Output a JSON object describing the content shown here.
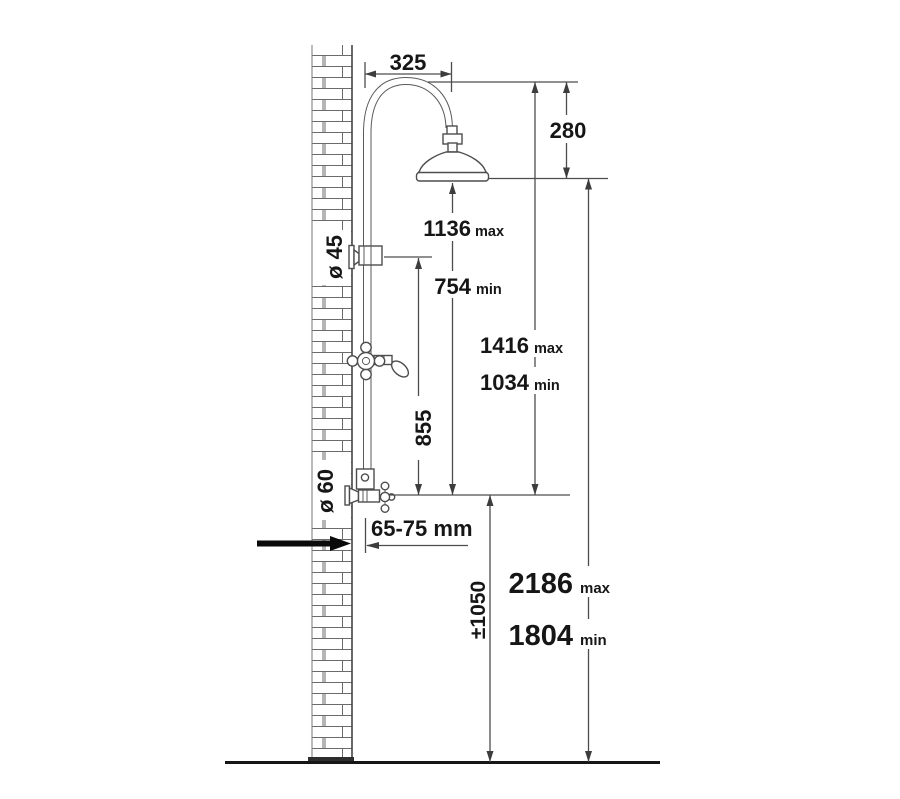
{
  "diagram": {
    "title": "shower-column-installation-dimensions",
    "colors": {
      "line": "#4d4d4d",
      "text": "#161616",
      "background": "#ffffff"
    },
    "dims": {
      "top_reach": {
        "value": "325"
      },
      "head_height": {
        "value": "280"
      },
      "head_max": {
        "value": "1136",
        "suffix": "max"
      },
      "head_min": {
        "value": "754",
        "suffix": "min"
      },
      "riser_max": {
        "value": "1416",
        "suffix": "max"
      },
      "riser_min": {
        "value": "1034",
        "suffix": "min"
      },
      "bracket_to_valve": {
        "value": "855"
      },
      "wall_offset": {
        "value": "65-75 mm"
      },
      "total_max": {
        "value": "2186",
        "suffix": "max"
      },
      "total_min": {
        "value": "1804",
        "suffix": "min"
      },
      "inlet_height": {
        "value": "±1050"
      },
      "upper_diameter": {
        "value": "ø 45"
      },
      "lower_diameter": {
        "value": "ø 60"
      }
    }
  }
}
